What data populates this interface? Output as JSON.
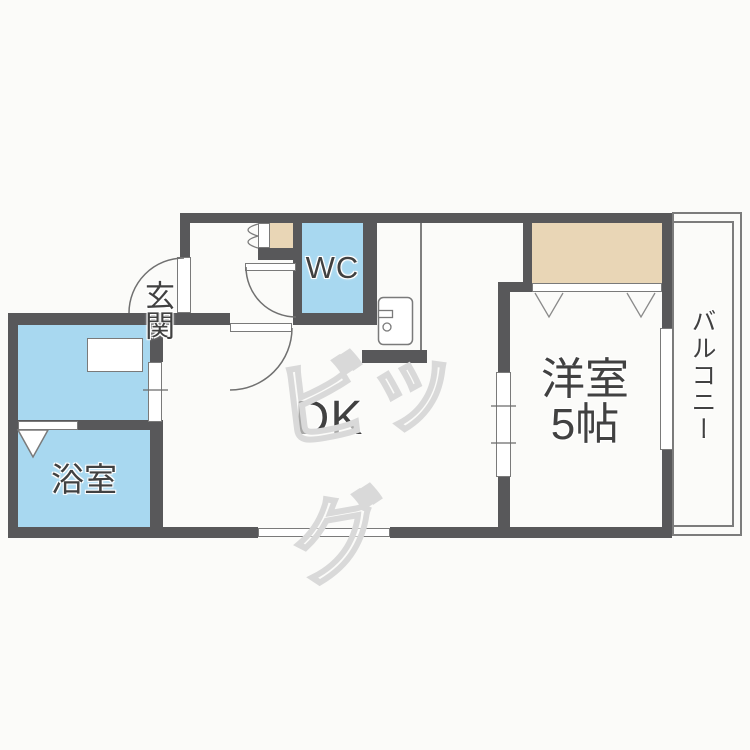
{
  "plan": {
    "title": "1DK apartment floor plan",
    "rooms": {
      "entrance": {
        "label": "玄関"
      },
      "wc": {
        "label": "WC"
      },
      "dk": {
        "label": "DK"
      },
      "bathroom": {
        "label": "浴室"
      },
      "western_room": {
        "label_line1": "洋室",
        "label_line2": "5帖"
      },
      "balcony": {
        "label": "バルコニー"
      }
    },
    "watermark": {
      "text": "ビッグ"
    },
    "colors": {
      "wall": "#58585a",
      "wet_area_fill": "#a8d8f0",
      "closet_fill": "#e9d6b6",
      "outline": "#7a7a7a",
      "label_text": "#414141",
      "watermark": "#d9d9d9",
      "background": "#fbfbf9"
    }
  }
}
